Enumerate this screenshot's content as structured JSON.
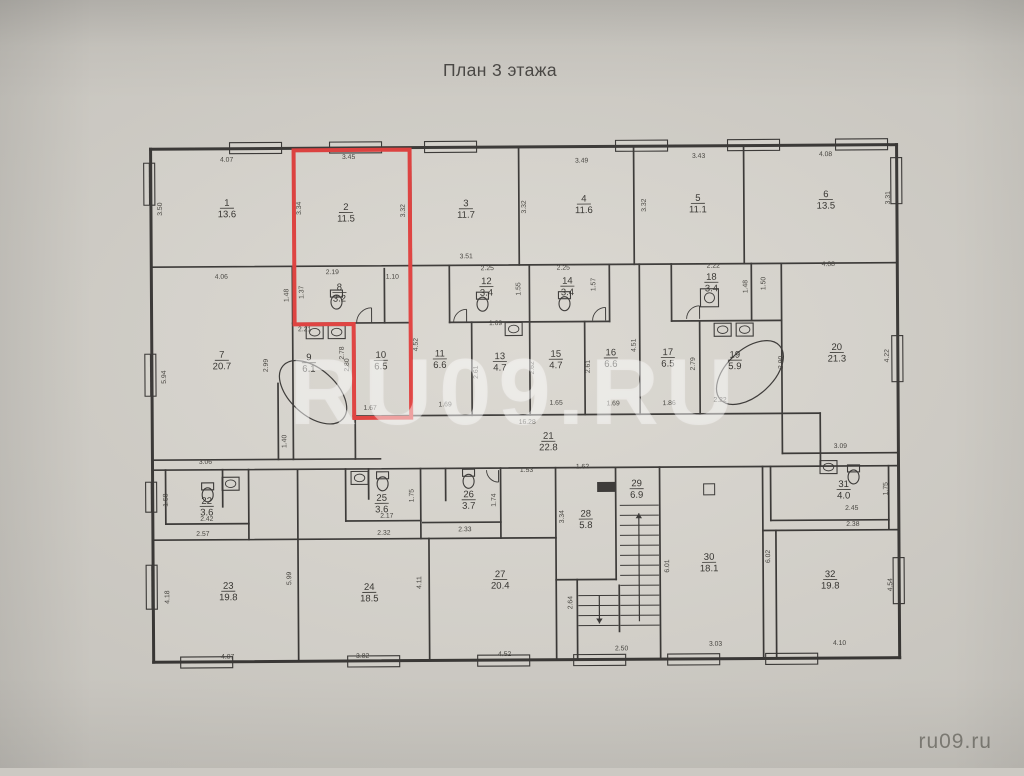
{
  "title": "План 3 этажа",
  "watermark_center": "RU09.RU",
  "watermark_corner": "ru09.ru",
  "colors": {
    "background": "#d3d0c9",
    "paper_light": "#d9d6cf",
    "wall": "#343230",
    "red": "#e13a38",
    "dim_text": "#3e3c37",
    "room_text": "#2e2c28",
    "watermark_center": "rgba(255,255,255,0.42)",
    "watermark_corner": "#84827a"
  },
  "rooms": [
    {
      "number": "1",
      "area": "13.6",
      "x": 228,
      "y": 205
    },
    {
      "number": "2",
      "area": "11.5",
      "x": 347,
      "y": 210
    },
    {
      "number": "3",
      "area": "11.7",
      "x": 467,
      "y": 207
    },
    {
      "number": "4",
      "area": "11.6",
      "x": 585,
      "y": 203
    },
    {
      "number": "5",
      "area": "11.1",
      "x": 699,
      "y": 203
    },
    {
      "number": "6",
      "area": "13.5",
      "x": 827,
      "y": 200
    },
    {
      "number": "7",
      "area": "20.7",
      "x": 222,
      "y": 357
    },
    {
      "number": "8",
      "area": "3.2",
      "x": 340,
      "y": 290
    },
    {
      "number": "9",
      "area": "6.1",
      "x": 309,
      "y": 360
    },
    {
      "number": "10",
      "area": "6.5",
      "x": 381,
      "y": 358
    },
    {
      "number": "11",
      "area": "6.6",
      "x": 440,
      "y": 357
    },
    {
      "number": "12",
      "area": "3.4",
      "x": 487,
      "y": 285
    },
    {
      "number": "13",
      "area": "4.7",
      "x": 500,
      "y": 360
    },
    {
      "number": "14",
      "area": "3.4",
      "x": 568,
      "y": 285
    },
    {
      "number": "15",
      "area": "4.7",
      "x": 556,
      "y": 358
    },
    {
      "number": "16",
      "area": "6.6",
      "x": 611,
      "y": 357
    },
    {
      "number": "17",
      "area": "6.5",
      "x": 668,
      "y": 357
    },
    {
      "number": "18",
      "area": "3.4",
      "x": 712,
      "y": 282
    },
    {
      "number": "19",
      "area": "5.9",
      "x": 735,
      "y": 360
    },
    {
      "number": "20",
      "area": "21.3",
      "x": 837,
      "y": 353
    },
    {
      "number": "21",
      "area": "22.8",
      "x": 548,
      "y": 440
    },
    {
      "number": "22",
      "area": "3.6",
      "x": 206,
      "y": 503
    },
    {
      "number": "23",
      "area": "19.8",
      "x": 227,
      "y": 588
    },
    {
      "number": "24",
      "area": "18.5",
      "x": 368,
      "y": 590
    },
    {
      "number": "25",
      "area": "3.6",
      "x": 381,
      "y": 501
    },
    {
      "number": "26",
      "area": "3.7",
      "x": 468,
      "y": 498
    },
    {
      "number": "27",
      "area": "20.4",
      "x": 499,
      "y": 578
    },
    {
      "number": "28",
      "area": "5.8",
      "x": 585,
      "y": 518
    },
    {
      "number": "29",
      "area": "6.9",
      "x": 636,
      "y": 488
    },
    {
      "number": "30",
      "area": "18.1",
      "x": 708,
      "y": 562
    },
    {
      "number": "31",
      "area": "4.0",
      "x": 843,
      "y": 490
    },
    {
      "number": "32",
      "area": "19.8",
      "x": 829,
      "y": 580
    }
  ],
  "dimensions": [
    {
      "t": "4.07",
      "x": 228,
      "y": 160,
      "r": 0
    },
    {
      "t": "3.45",
      "x": 350,
      "y": 158,
      "r": 0
    },
    {
      "t": "3.49",
      "x": 583,
      "y": 163,
      "r": 0
    },
    {
      "t": "3.43",
      "x": 700,
      "y": 159,
      "r": 0
    },
    {
      "t": "4.08",
      "x": 827,
      "y": 158,
      "r": 0
    },
    {
      "t": "3.50",
      "x": 163,
      "y": 207,
      "r": 1
    },
    {
      "t": "3.34",
      "x": 302,
      "y": 207,
      "r": 1
    },
    {
      "t": "3.32",
      "x": 406,
      "y": 210,
      "r": 1
    },
    {
      "t": "3.51",
      "x": 467,
      "y": 258,
      "r": 0
    },
    {
      "t": "3.32",
      "x": 527,
      "y": 207,
      "r": 1
    },
    {
      "t": "3.32",
      "x": 647,
      "y": 206,
      "r": 1
    },
    {
      "t": "3.31",
      "x": 891,
      "y": 200,
      "r": 1
    },
    {
      "t": "4.06",
      "x": 222,
      "y": 277,
      "r": 0
    },
    {
      "t": "2.19",
      "x": 333,
      "y": 273,
      "r": 0
    },
    {
      "t": "1.10",
      "x": 393,
      "y": 278,
      "r": 0
    },
    {
      "t": "1.48",
      "x": 289,
      "y": 294,
      "r": 1
    },
    {
      "t": "1.37",
      "x": 304,
      "y": 291,
      "r": 1
    },
    {
      "t": "2.21",
      "x": 305,
      "y": 330,
      "r": 0
    },
    {
      "t": "2.78",
      "x": 344,
      "y": 352,
      "r": 1
    },
    {
      "t": "2.99",
      "x": 268,
      "y": 364,
      "r": 1
    },
    {
      "t": "5.94",
      "x": 166,
      "y": 375,
      "r": 1
    },
    {
      "t": "2.80",
      "x": 349,
      "y": 364,
      "r": 1
    },
    {
      "t": "4.52",
      "x": 418,
      "y": 344,
      "r": 1
    },
    {
      "t": "1.67",
      "x": 370,
      "y": 409,
      "r": 0
    },
    {
      "t": "2.25",
      "x": 488,
      "y": 270,
      "r": 0
    },
    {
      "t": "1.55",
      "x": 521,
      "y": 289,
      "r": 1
    },
    {
      "t": "1.69",
      "x": 496,
      "y": 325,
      "r": 0
    },
    {
      "t": "2.61",
      "x": 478,
      "y": 372,
      "r": 1
    },
    {
      "t": "2.25",
      "x": 564,
      "y": 270,
      "r": 0
    },
    {
      "t": "1.57",
      "x": 596,
      "y": 285,
      "r": 1
    },
    {
      "t": "2.62",
      "x": 534,
      "y": 368,
      "r": 1
    },
    {
      "t": "1.65",
      "x": 556,
      "y": 405,
      "r": 0
    },
    {
      "t": "2.61",
      "x": 590,
      "y": 367,
      "r": 1
    },
    {
      "t": "1.69",
      "x": 613,
      "y": 406,
      "r": 0
    },
    {
      "t": "4.51",
      "x": 636,
      "y": 346,
      "r": 1
    },
    {
      "t": "1.86",
      "x": 669,
      "y": 406,
      "r": 0
    },
    {
      "t": "2.79",
      "x": 695,
      "y": 365,
      "r": 1
    },
    {
      "t": "2.22",
      "x": 714,
      "y": 269,
      "r": 0
    },
    {
      "t": "1.48",
      "x": 748,
      "y": 288,
      "r": 1
    },
    {
      "t": "1.50",
      "x": 766,
      "y": 285,
      "r": 1
    },
    {
      "t": "2.22",
      "x": 720,
      "y": 403,
      "r": 0
    },
    {
      "t": "2.90",
      "x": 783,
      "y": 364,
      "r": 1
    },
    {
      "t": "4.08",
      "x": 829,
      "y": 268,
      "r": 0
    },
    {
      "t": "4.22",
      "x": 889,
      "y": 358,
      "r": 1
    },
    {
      "t": "16.28",
      "x": 527,
      "y": 424,
      "r": 0
    },
    {
      "t": "1.40",
      "x": 286,
      "y": 440,
      "r": 1
    },
    {
      "t": "3.06",
      "x": 205,
      "y": 462,
      "r": 0
    },
    {
      "t": "1.69",
      "x": 445,
      "y": 406,
      "r": 0
    },
    {
      "t": "2.42",
      "x": 206,
      "y": 519,
      "r": 0
    },
    {
      "t": "2.57",
      "x": 202,
      "y": 534,
      "r": 0
    },
    {
      "t": "1.58",
      "x": 167,
      "y": 498,
      "r": 1
    },
    {
      "t": "2.17",
      "x": 386,
      "y": 517,
      "r": 0
    },
    {
      "t": "2.32",
      "x": 383,
      "y": 534,
      "r": 0
    },
    {
      "t": "1.75",
      "x": 413,
      "y": 495,
      "r": 1
    },
    {
      "t": "1.53",
      "x": 526,
      "y": 472,
      "r": 0
    },
    {
      "t": "2.33",
      "x": 464,
      "y": 531,
      "r": 0
    },
    {
      "t": "1.74",
      "x": 495,
      "y": 500,
      "r": 1
    },
    {
      "t": "1.62",
      "x": 582,
      "y": 469,
      "r": 0
    },
    {
      "t": "3.34",
      "x": 563,
      "y": 517,
      "r": 1
    },
    {
      "t": "2.64",
      "x": 571,
      "y": 603,
      "r": 1
    },
    {
      "t": "2.50",
      "x": 620,
      "y": 651,
      "r": 0
    },
    {
      "t": "4.18",
      "x": 168,
      "y": 595,
      "r": 1
    },
    {
      "t": "5.99",
      "x": 290,
      "y": 577,
      "r": 1
    },
    {
      "t": "4.07",
      "x": 226,
      "y": 657,
      "r": 0
    },
    {
      "t": "3.82",
      "x": 361,
      "y": 657,
      "r": 0
    },
    {
      "t": "4.11",
      "x": 420,
      "y": 582,
      "r": 1
    },
    {
      "t": "4.52",
      "x": 503,
      "y": 656,
      "r": 0
    },
    {
      "t": "6.01",
      "x": 668,
      "y": 567,
      "r": 1
    },
    {
      "t": "6.02",
      "x": 769,
      "y": 558,
      "r": 1
    },
    {
      "t": "3.03",
      "x": 714,
      "y": 647,
      "r": 0
    },
    {
      "t": "3.09",
      "x": 840,
      "y": 450,
      "r": 0
    },
    {
      "t": "2.45",
      "x": 851,
      "y": 512,
      "r": 0
    },
    {
      "t": "2.38",
      "x": 852,
      "y": 528,
      "r": 0
    },
    {
      "t": "1.75",
      "x": 887,
      "y": 491,
      "r": 1
    },
    {
      "t": "4.10",
      "x": 838,
      "y": 647,
      "r": 0
    },
    {
      "t": "4.54",
      "x": 891,
      "y": 587,
      "r": 1
    }
  ],
  "plan": {
    "building": {
      "x": 152,
      "y": 147,
      "w": 746,
      "h": 513
    },
    "outer_walls": [
      [
        152,
        147,
        898,
        147
      ],
      [
        898,
        147,
        898,
        660
      ],
      [
        152,
        660,
        898,
        660
      ],
      [
        152,
        147,
        152,
        660
      ]
    ],
    "walls": [
      [
        152,
        265,
        898,
        265
      ],
      [
        293,
        322,
        412,
        322
      ],
      [
        450,
        322,
        610,
        322
      ],
      [
        672,
        322,
        782,
        322
      ],
      [
        353,
        415,
        820,
        415
      ],
      [
        152,
        458,
        380,
        458
      ],
      [
        782,
        455,
        898,
        455
      ],
      [
        152,
        468,
        898,
        468
      ],
      [
        165,
        522,
        248,
        522
      ],
      [
        345,
        520,
        420,
        520
      ],
      [
        422,
        522,
        500,
        522
      ],
      [
        770,
        522,
        888,
        522
      ],
      [
        762,
        532,
        898,
        532
      ],
      [
        152,
        538,
        555,
        538
      ],
      [
        555,
        580,
        615,
        580
      ],
      [
        295,
        147,
        295,
        265
      ],
      [
        412,
        147,
        412,
        265
      ],
      [
        520,
        147,
        520,
        265
      ],
      [
        635,
        147,
        635,
        265
      ],
      [
        745,
        147,
        745,
        265
      ],
      [
        293,
        265,
        293,
        458
      ],
      [
        385,
        268,
        385,
        322
      ],
      [
        412,
        265,
        412,
        415
      ],
      [
        450,
        265,
        450,
        322
      ],
      [
        472,
        322,
        472,
        415
      ],
      [
        530,
        265,
        530,
        415
      ],
      [
        610,
        265,
        610,
        322
      ],
      [
        585,
        322,
        585,
        415
      ],
      [
        640,
        265,
        640,
        415
      ],
      [
        672,
        265,
        672,
        322
      ],
      [
        752,
        265,
        752,
        322
      ],
      [
        700,
        322,
        700,
        415
      ],
      [
        782,
        265,
        782,
        455
      ],
      [
        820,
        415,
        820,
        468
      ],
      [
        355,
        322,
        355,
        458
      ],
      [
        278,
        382,
        278,
        458
      ],
      [
        165,
        468,
        165,
        522
      ],
      [
        222,
        468,
        222,
        505
      ],
      [
        248,
        468,
        248,
        538
      ],
      [
        297,
        468,
        297,
        660
      ],
      [
        345,
        468,
        345,
        520
      ],
      [
        368,
        468,
        368,
        498
      ],
      [
        420,
        468,
        420,
        538
      ],
      [
        445,
        468,
        445,
        500
      ],
      [
        500,
        468,
        500,
        538
      ],
      [
        555,
        468,
        555,
        660
      ],
      [
        615,
        468,
        615,
        580
      ],
      [
        576,
        580,
        576,
        660
      ],
      [
        618,
        586,
        618,
        632
      ],
      [
        659,
        468,
        659,
        660
      ],
      [
        762,
        468,
        762,
        660
      ],
      [
        775,
        532,
        775,
        660
      ],
      [
        770,
        468,
        770,
        522
      ],
      [
        888,
        468,
        888,
        532
      ],
      [
        428,
        538,
        428,
        660
      ]
    ],
    "windows": [
      [
        231,
        141,
        52,
        11
      ],
      [
        331,
        141,
        52,
        11
      ],
      [
        426,
        141,
        52,
        11
      ],
      [
        617,
        141,
        52,
        11
      ],
      [
        729,
        141,
        52,
        11
      ],
      [
        837,
        141,
        52,
        11
      ],
      [
        179,
        655,
        52,
        11
      ],
      [
        346,
        655,
        52,
        11
      ],
      [
        476,
        655,
        52,
        11
      ],
      [
        572,
        655,
        52,
        11
      ],
      [
        666,
        655,
        52,
        11
      ],
      [
        764,
        655,
        52,
        11
      ],
      [
        145,
        161,
        11,
        42
      ],
      [
        145,
        352,
        11,
        42
      ],
      [
        145,
        480,
        11,
        30
      ],
      [
        145,
        563,
        11,
        44
      ],
      [
        892,
        160,
        11,
        46
      ],
      [
        892,
        338,
        11,
        46
      ],
      [
        892,
        560,
        11,
        46
      ]
    ],
    "red_outline": "295,149 411,149 411,417 354,417 354,323 295,323",
    "stairs": {
      "flights": [
        {
          "x1": 619,
          "x2": 658,
          "yStart": 506,
          "yEnd": 626,
          "step": 10
        },
        {
          "x1": 577,
          "x2": 617,
          "yStart": 596,
          "yEnd": 626,
          "step": 10
        }
      ],
      "arrows": [
        {
          "x": 638,
          "yFrom": 622,
          "yTo": 514
        },
        {
          "x": 598,
          "yFrom": 596,
          "yTo": 624
        }
      ]
    },
    "fixtures": {
      "toilets": [
        [
          337,
          299
        ],
        [
          483,
          302
        ],
        [
          565,
          302
        ],
        [
          207,
          491
        ],
        [
          382,
          481
        ],
        [
          468,
          479
        ],
        [
          853,
          477
        ]
      ],
      "sinks": [
        [
          315,
          331
        ],
        [
          337,
          331
        ],
        [
          514,
          329
        ],
        [
          723,
          331
        ],
        [
          745,
          331
        ],
        [
          230,
          482
        ],
        [
          359,
          477
        ],
        [
          828,
          469
        ]
      ],
      "washers": [
        [
          710,
          299
        ]
      ],
      "tubs": [
        {
          "x": 313,
          "y": 391,
          "rx": 40,
          "ry": 23,
          "rot": 42
        },
        {
          "x": 750,
          "y": 374,
          "rx": 40,
          "ry": 23,
          "rot": -42
        }
      ],
      "door_arcs": [
        [
          372,
          322,
          15,
          -1,
          -1
        ],
        [
          467,
          322,
          13,
          -1,
          -1
        ],
        [
          606,
          321,
          13,
          -1,
          -1
        ],
        [
          700,
          320,
          13,
          -1,
          -1
        ],
        [
          498,
          470,
          12,
          -1,
          1
        ]
      ],
      "vents": [
        {
          "x": 597,
          "y": 483,
          "w": 17,
          "h": 9,
          "filled": true
        },
        {
          "x": 703,
          "y": 485,
          "w": 11,
          "h": 11,
          "filled": false
        }
      ]
    }
  }
}
